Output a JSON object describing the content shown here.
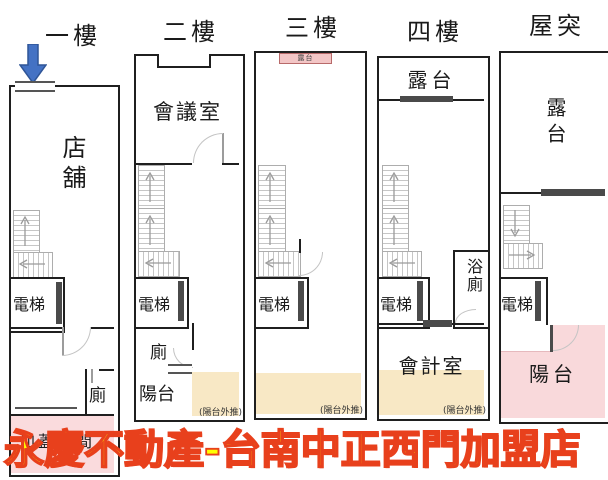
{
  "floors": [
    {
      "label": "一樓",
      "rooms": {
        "shop": "店舖",
        "elevator": "電梯",
        "toilet": "廁",
        "addition": "加蓋空間"
      }
    },
    {
      "label": "二樓",
      "rooms": {
        "meeting_room": "會議室",
        "elevator": "電梯",
        "toilet": "廁",
        "balcony": "陽台"
      },
      "note": "(陽台外推)"
    },
    {
      "label": "三樓",
      "rooms": {
        "front_terrace": "露台",
        "elevator": "電梯"
      },
      "note": "(陽台外推)"
    },
    {
      "label": "四樓",
      "rooms": {
        "terrace": "露台",
        "elevator": "電梯",
        "bathroom": "浴廁",
        "accounting_room": "會計室"
      },
      "note": "(陽台外推)"
    },
    {
      "label": "屋突",
      "rooms": {
        "terrace": "露台",
        "elevator": "電梯",
        "balcony": "陽台"
      }
    }
  ],
  "watermark": {
    "text": "永慶不動產-台南中正西門加盟店"
  },
  "icons": {
    "entrance_arrow": "down-arrow",
    "stair_up": "up-arrow",
    "stair_down": "down-arrow",
    "stair_turn": "side-arrow"
  },
  "colors": {
    "addition_pink": "#fadbdd",
    "balcony_pink": "#f9d9db",
    "outset_cream": "#f8e8c5",
    "watermark_fill": "#ffff00",
    "watermark_outline": "#e8401c",
    "arrow_blue": "#4472c4",
    "wall": "#1f1f1f"
  }
}
